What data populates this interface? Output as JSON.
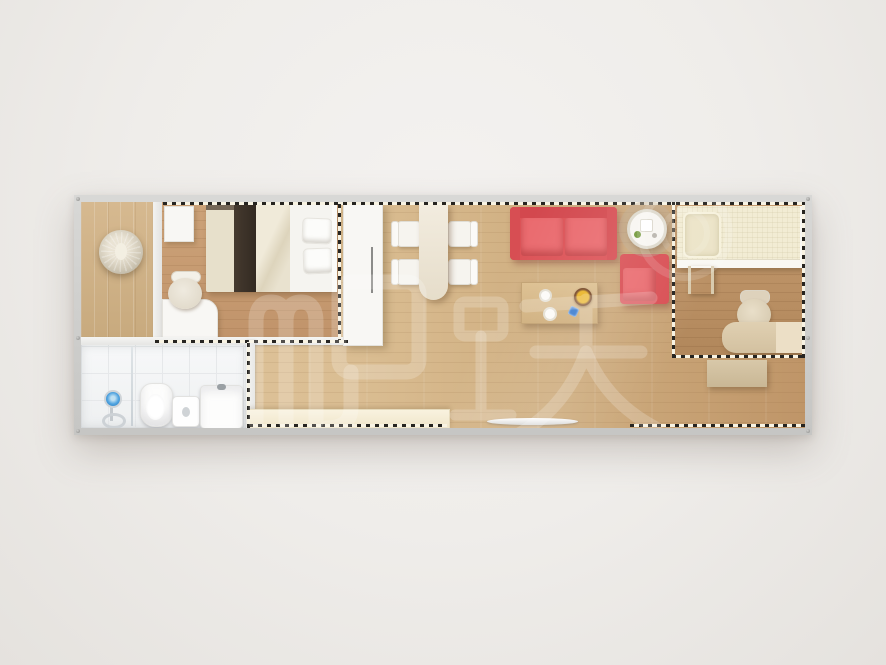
{
  "scene": {
    "title": "Top-down 3D floor plan render of a long prefab container home",
    "canvas": {
      "width": 886,
      "height": 665
    },
    "background_color": "#efedea",
    "frame_color": "#cdcdcb"
  },
  "watermark": {
    "text": "爬跃",
    "mark": "translucent circular logo ring",
    "color": "#ffffff",
    "opacity": 0.2
  },
  "palette": {
    "floor_living": "#d8bb8e",
    "floor_bedroom": "#c79c70",
    "floor_right_bedroom": "#bb9065",
    "floor_porch": "#cfb289",
    "bathroom_tile": "#f4f5f6",
    "sofa_red": "#e25a5e",
    "bed_cream": "#ece5cf",
    "wood_table": "#d9bc8d",
    "white_furniture": "#f7f5f1",
    "module_dash": "#262420"
  },
  "rooms": [
    {
      "id": "porch",
      "label": "entry porch with round pendant decoration"
    },
    {
      "id": "master-bedroom",
      "label": "bedroom with double bed, storage box, desk and chair"
    },
    {
      "id": "bathroom",
      "label": "bathroom with shower set, glass divider, toilet, basin, washing machine"
    },
    {
      "id": "living-dining",
      "label": "open living-dining area"
    },
    {
      "id": "second-bedroom",
      "label": "second bedroom with single loft bed, ladder, office desk and chair"
    }
  ],
  "furniture": [
    "pendant-lamp",
    "storage-box",
    "double-bed",
    "writing-desk",
    "desk-chair",
    "shower-set",
    "glass-divider",
    "toilet",
    "wash-basin",
    "washing-machine",
    "white-wardrobe",
    "dining-table",
    "dining-chair-1",
    "dining-chair-2",
    "dining-chair-3",
    "dining-chair-4",
    "red-sofa",
    "red-armchair",
    "round-side-table",
    "coffee-table",
    "fruit-bowl",
    "low-counter",
    "door-threshold",
    "single-bed",
    "bunk-ladder",
    "office-chair",
    "office-desk",
    "drawer-unit"
  ]
}
